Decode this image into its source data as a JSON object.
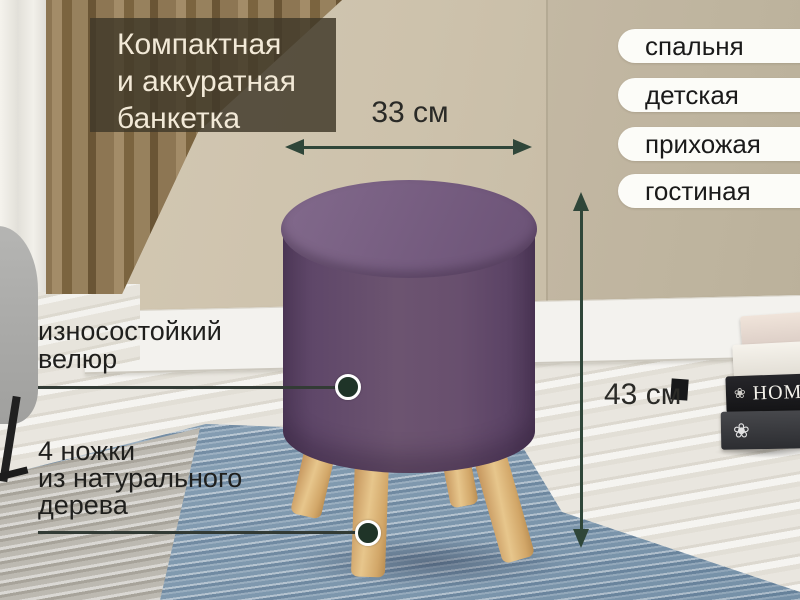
{
  "title": {
    "line1": "Компактная",
    "line2": "и аккуратная",
    "line3": "банкетка"
  },
  "room_tags": {
    "items": [
      {
        "label": "спальня"
      },
      {
        "label": "детская"
      },
      {
        "label": "прихожая"
      },
      {
        "label": "гостиная"
      }
    ]
  },
  "dimensions": {
    "width": "33 см",
    "height": "43 см"
  },
  "callouts": {
    "velour": {
      "line1": "износостойкий",
      "line2": "велюр"
    },
    "legs": {
      "line1": "4 ножки",
      "line2": "из натурального",
      "line3": "дерева"
    }
  },
  "decor": {
    "book_spine": "HOME",
    "book_ornament": "❀"
  },
  "colors": {
    "arrow_green": "#2f4639",
    "pouf_purple": "#654d6e",
    "leg_wood": "#ddb478",
    "tag_background": "#fcfcf8",
    "title_background": "rgba(64,56,41,0.83)",
    "title_text": "#f2e9d7",
    "wall_beige": "#cdc2ad",
    "rug_blue": "#8fa7bb"
  }
}
